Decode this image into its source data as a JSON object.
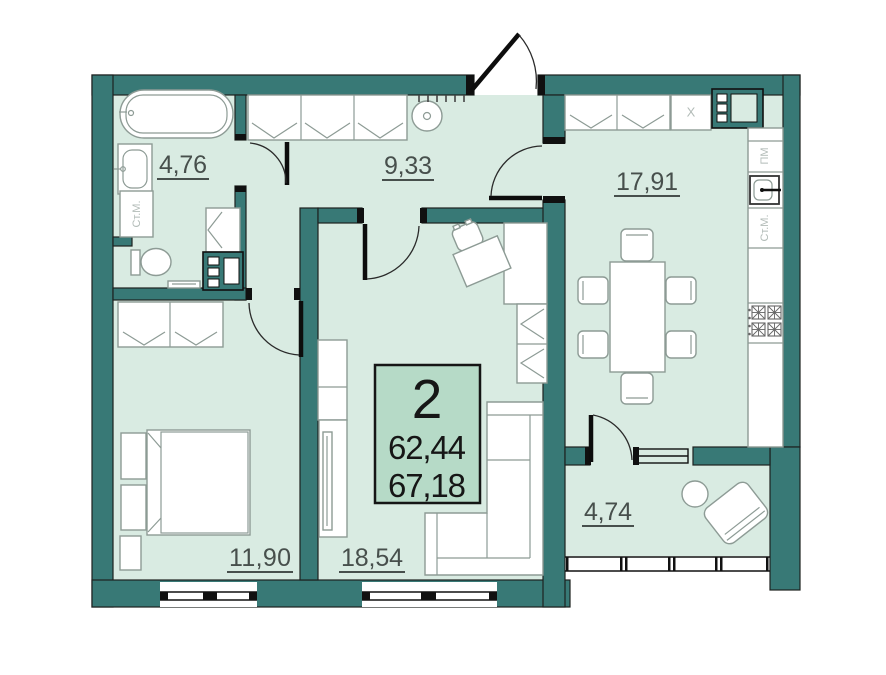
{
  "apartment": {
    "number": "2",
    "area_1": "62,44",
    "area_2": "67,18"
  },
  "rooms": [
    {
      "name": "bathroom",
      "area": "4,76"
    },
    {
      "name": "hallway",
      "area": "9,33"
    },
    {
      "name": "kitchen",
      "area": "17,91"
    },
    {
      "name": "bedroom",
      "area": "11,90"
    },
    {
      "name": "living-room",
      "area": "18,54"
    },
    {
      "name": "balcony",
      "area": "4,74"
    }
  ],
  "appliance_labels": {
    "washing_machine": "Ст.М.",
    "dishwasher": "ПМ",
    "fridge": "X"
  },
  "colors": {
    "wall": "#387976",
    "floor": "#d9ebe2",
    "info_box": "#b6dac7",
    "outline": "#1d211f",
    "furniture_stroke": "#8d9b95",
    "label": "#474f4c",
    "appliance_label": "#b3bcb8",
    "door": "#0d0d0d"
  }
}
